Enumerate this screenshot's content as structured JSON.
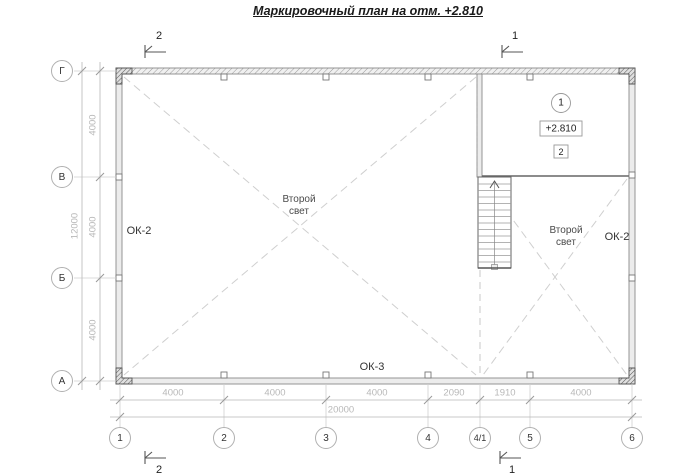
{
  "title": "Маркировочный план на отм. +2.810",
  "grid": {
    "columns": [
      "1",
      "2",
      "3",
      "4",
      "4/1",
      "5",
      "6"
    ],
    "rows": [
      "Г",
      "В",
      "Б",
      "А"
    ]
  },
  "dimensions": {
    "bottom_segments": [
      "4000",
      "4000",
      "4000",
      "2090",
      "1910",
      "4000"
    ],
    "bottom_total": "20000",
    "left_segments": [
      "4000",
      "4000",
      "4000"
    ],
    "left_total": "12000"
  },
  "sections": {
    "top_left": "2",
    "top_right": "1",
    "bottom_left": "2",
    "bottom_right": "1"
  },
  "labels": {
    "window_left": "ОК-2",
    "window_right": "ОК-2",
    "window_bottom": "ОК-3",
    "second_light_left": "Второй свет",
    "second_light_right": "Второй свет"
  },
  "room": {
    "number": "1",
    "elevation": "+2.810",
    "marker": "2"
  },
  "colors": {
    "wall_fill": "#ececec",
    "line_gray": "#b8b8b8",
    "dash_gray": "#cfcfcf",
    "text_dark": "#222222"
  }
}
